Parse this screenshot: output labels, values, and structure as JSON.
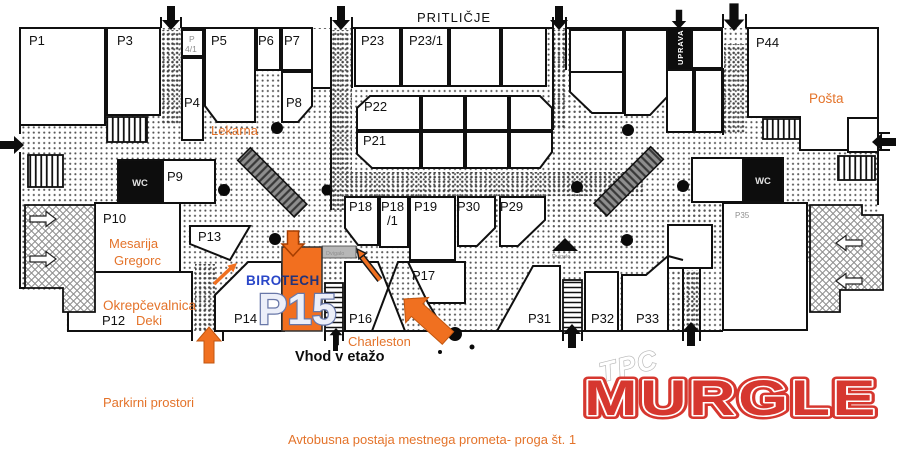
{
  "floor_title": "PRITLIČJE",
  "units": {
    "p1": "P1",
    "p3": "P3",
    "p4": "P4",
    "p4_1_line1": "P",
    "p4_1_line2": "4/1",
    "p5": "P5",
    "p6": "P6",
    "p7": "P7",
    "p8": "P8",
    "p9": "P9",
    "p10": "P10",
    "p12": "P12",
    "p13": "P13",
    "p14": "P14",
    "p16": "P16",
    "p17": "P17",
    "p18": "P18",
    "p18_1_line1": "P18",
    "p18_1_line2": "/1",
    "p19": "P19",
    "p21": "P21",
    "p22": "P22",
    "p23": "P23",
    "p23_1": "P23/1",
    "p29": "P29",
    "p30": "P30",
    "p31": "P31",
    "p32": "P32",
    "p33": "P33",
    "p35": "P35",
    "p44": "P44"
  },
  "highlight": {
    "unit": "P15",
    "tenant_part1": "BIRO",
    "tenant_part2": "TECH"
  },
  "tenants": {
    "lekarna": "Lekarna",
    "posta": "Pošta",
    "mesarija_line1": "Mesarija",
    "mesarija_line2": "Gregorc",
    "okrepcevalnica": "Okrepčevalnica",
    "deki": "Deki",
    "charleston": "Charleston"
  },
  "facilities": {
    "wc_left": "WC",
    "wc_right": "WC",
    "uprava": "UPRAVA",
    "dvigalo_left": "Dvigalo",
    "dvigalo_center": "Dvigalo"
  },
  "annotations": {
    "entrance_label": "Vhod v etažo",
    "parking_label": "Parkirni prostori",
    "bus_label": "Avtobusna postaja mestnega prometa- proga št. 1"
  },
  "logo": {
    "top": "TPC",
    "main": "MURGLE"
  },
  "colors": {
    "highlight_orange": "#F26F1F",
    "arrow_orange": "#F07020",
    "label_orange": "#E4732A",
    "logo_red": "#D6372F",
    "biro_blue": "#2946C8",
    "tech_navy": "#22337A"
  }
}
